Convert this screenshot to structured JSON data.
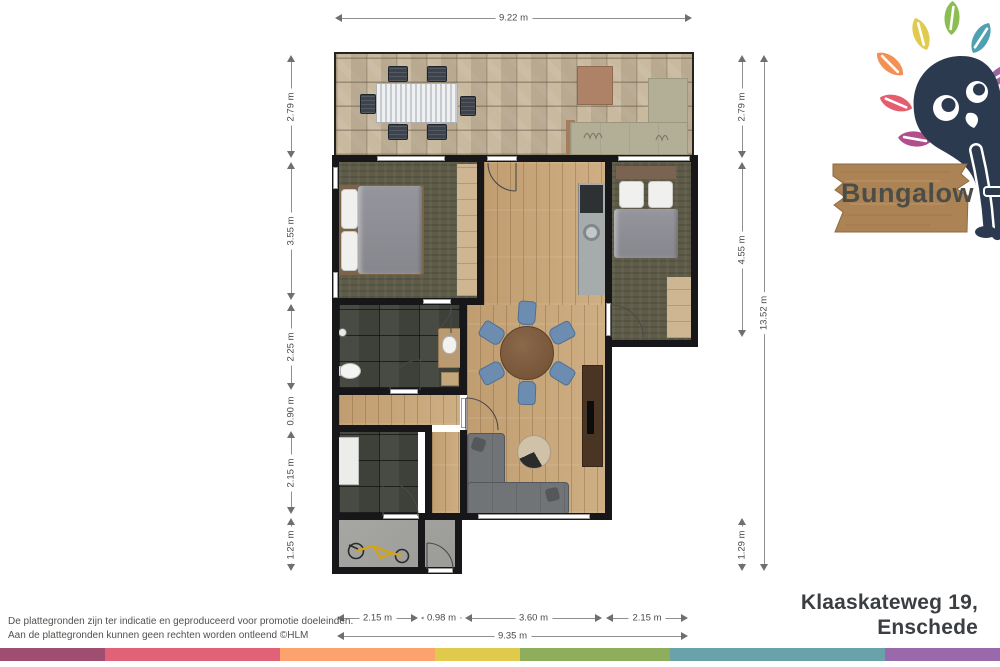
{
  "brand": {
    "name": "Bungalow",
    "mascot": "bird-mascot-with-leaves",
    "mascot_color": "#2C3A50",
    "sign_wood_color": "#AC8355",
    "leaf_colors": [
      "#F29055",
      "#E1CB4D",
      "#8BBD53",
      "#4FA0B0",
      "#9D64A5",
      "#E55E6F",
      "#B04F8C"
    ]
  },
  "address": {
    "line1": "Klaaskateweg 19,",
    "line2": "Enschede"
  },
  "disclaimer": {
    "line1": "De plattegronden zijn ter indicatie en geproduceerd voor promotie doeleinden.",
    "line2": "Aan de plattegronden kunnen geen rechten worden ontleend ©HLM"
  },
  "dimensions": {
    "top_total": "9.22 m",
    "left": [
      "2.79 m",
      "3.55 m",
      "2.25 m",
      "0.90 m",
      "2.15 m",
      "1.25 m"
    ],
    "right": [
      "2.79 m",
      "4.55 m",
      "1.29 m"
    ],
    "right_total": "13.52 m",
    "bottom": [
      "2.15 m",
      "0.98 m",
      "3.60 m",
      "2.15 m"
    ],
    "bottom_total": "9.35 m"
  },
  "palette_bar": [
    "#9D4E71",
    "#E16278",
    "#FBA26E",
    "#E0CA4C",
    "#8EAE5B",
    "#69A2AB",
    "#9A69AC"
  ]
}
